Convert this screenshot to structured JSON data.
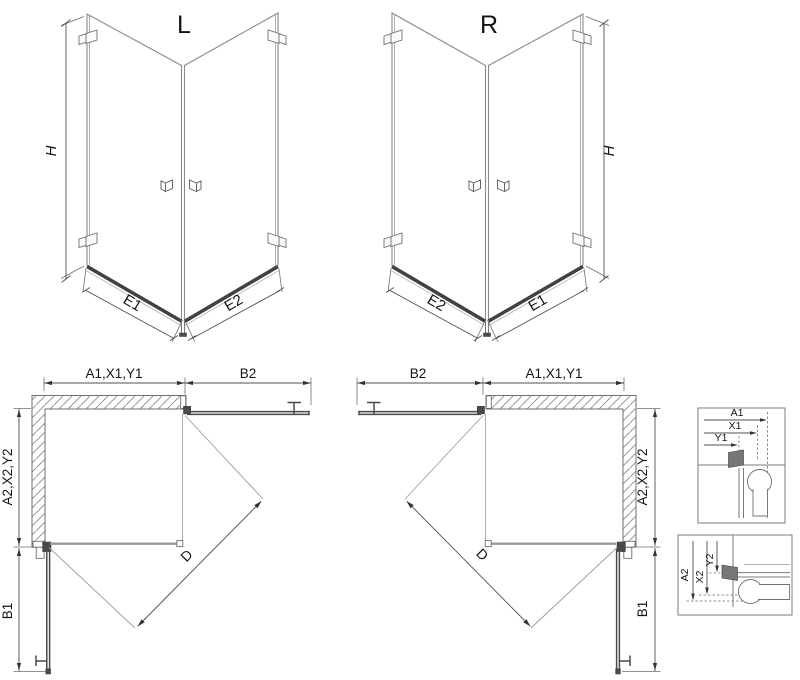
{
  "iso_left": {
    "label": "L",
    "h": "H",
    "e1": "E1",
    "e2": "E2"
  },
  "iso_right": {
    "label": "R",
    "h": "H",
    "e1": "E1",
    "e2": "E2"
  },
  "plan_left": {
    "wall_dims": "A1,X1,Y1",
    "door_top": "B2",
    "wall_side_dims": "A2,X2,Y2",
    "door_side": "B1",
    "entry": "D"
  },
  "plan_right": {
    "wall_dims": "A1,X1,Y1",
    "door_top": "B2",
    "wall_side_dims": "A2,X2,Y2",
    "door_side": "B1",
    "entry": "D"
  },
  "details": {
    "top": {
      "d1": "A1",
      "d2": "X1",
      "d3": "Y1"
    },
    "bottom": {
      "d1": "A2",
      "d2": "X2",
      "d3": "Y2"
    }
  },
  "colors": {
    "line": "#7a7a7a",
    "dim": "#4f4f4f",
    "dark": "#414141",
    "text": "#141414",
    "swing": "#9c9c9c",
    "hatch": "#999999"
  }
}
